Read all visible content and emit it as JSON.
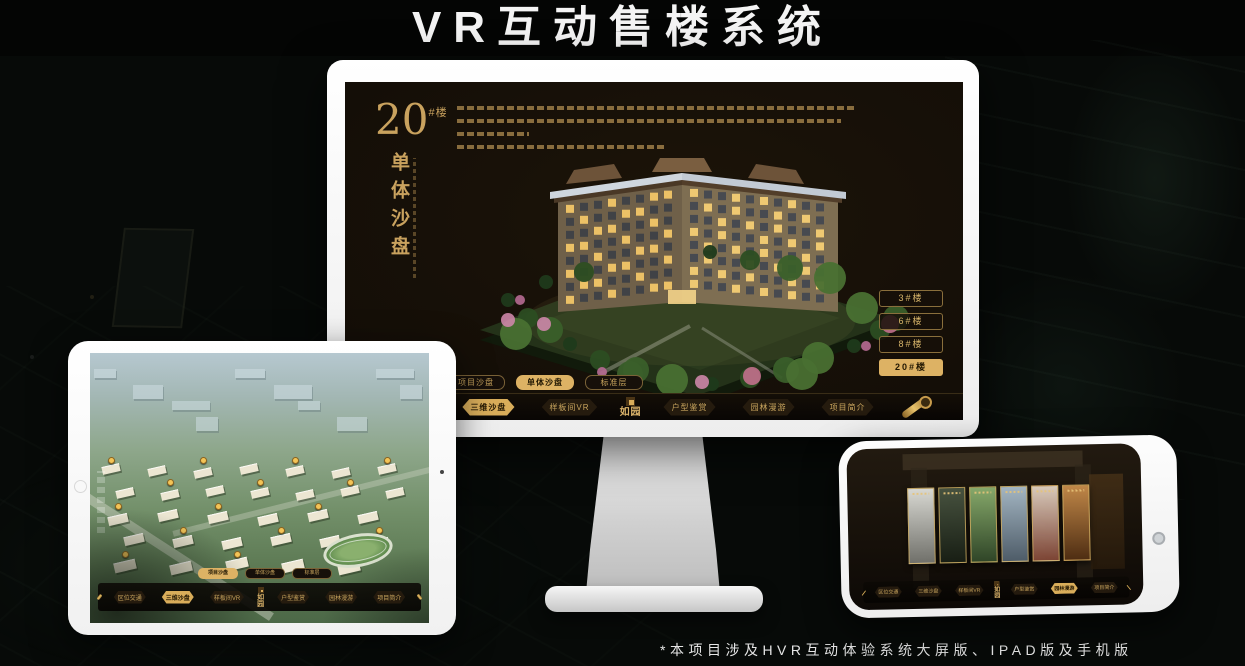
{
  "page": {
    "title": "VR互动售楼系统",
    "footnote": "*本项目涉及HVR互动体验系统大屏版、IPAD版及手机版"
  },
  "colors": {
    "gold": "#c9a25e",
    "gold_bright": "#ddb264",
    "gold_text_dark": "#241803",
    "monitor_screen_bg": "#140e07",
    "device_body": "#ffffff"
  },
  "monitor_app": {
    "headline": {
      "number": "20",
      "suffix": "#楼",
      "vertical_title": "单体沙盘"
    },
    "floor_buttons": [
      {
        "label": "3#楼",
        "active": false
      },
      {
        "label": "6#楼",
        "active": false
      },
      {
        "label": "8#楼",
        "active": false
      },
      {
        "label": "20#楼",
        "active": true
      }
    ],
    "view_tabs": [
      {
        "label": "项目沙盘",
        "active": false
      },
      {
        "label": "单体沙盘",
        "active": true
      },
      {
        "label": "标准层",
        "active": false
      }
    ],
    "nav": {
      "logo": "如园",
      "items": [
        {
          "label": "区位交通",
          "active": false
        },
        {
          "label": "三维沙盘",
          "active": true
        },
        {
          "label": "样板间VR",
          "active": false
        },
        {
          "label": "户型鉴赏",
          "active": false
        },
        {
          "label": "园林漫游",
          "active": false
        },
        {
          "label": "项目简介",
          "active": false
        }
      ]
    }
  },
  "tablet_app": {
    "view_tabs": [
      {
        "label": "项目沙盘",
        "active": true
      },
      {
        "label": "单体沙盘",
        "active": false
      },
      {
        "label": "标准层",
        "active": false
      }
    ],
    "nav": {
      "logo": "如园",
      "items": [
        {
          "label": "区位交通",
          "active": false
        },
        {
          "label": "三维沙盘",
          "active": true
        },
        {
          "label": "样板间VR",
          "active": false
        },
        {
          "label": "户型鉴赏",
          "active": false
        },
        {
          "label": "园林漫游",
          "active": false
        },
        {
          "label": "项目简介",
          "active": false
        }
      ]
    }
  },
  "phone_app": {
    "nav": {
      "logo": "如园",
      "items": [
        {
          "label": "区位交通",
          "active": false
        },
        {
          "label": "三维沙盘",
          "active": false
        },
        {
          "label": "样板间VR",
          "active": false
        },
        {
          "label": "户型鉴赏",
          "active": false
        },
        {
          "label": "园林漫游",
          "active": true
        },
        {
          "label": "项目简介",
          "active": false
        }
      ]
    },
    "panels": [
      {
        "name": "ink-courtyard",
        "colors": [
          "#d8d8d2",
          "#70706a"
        ]
      },
      {
        "name": "dark-stairs",
        "colors": [
          "#47523f",
          "#181e14"
        ]
      },
      {
        "name": "garden-path",
        "colors": [
          "#86a86a",
          "#2f4527"
        ]
      },
      {
        "name": "building-facade",
        "colors": [
          "#a3b5c2",
          "#4e5c68"
        ]
      },
      {
        "name": "autumn-courtyard",
        "colors": [
          "#d8cabb",
          "#7c4434"
        ]
      },
      {
        "name": "wood-interior",
        "colors": [
          "#c08748",
          "#4e2d12"
        ]
      }
    ]
  }
}
